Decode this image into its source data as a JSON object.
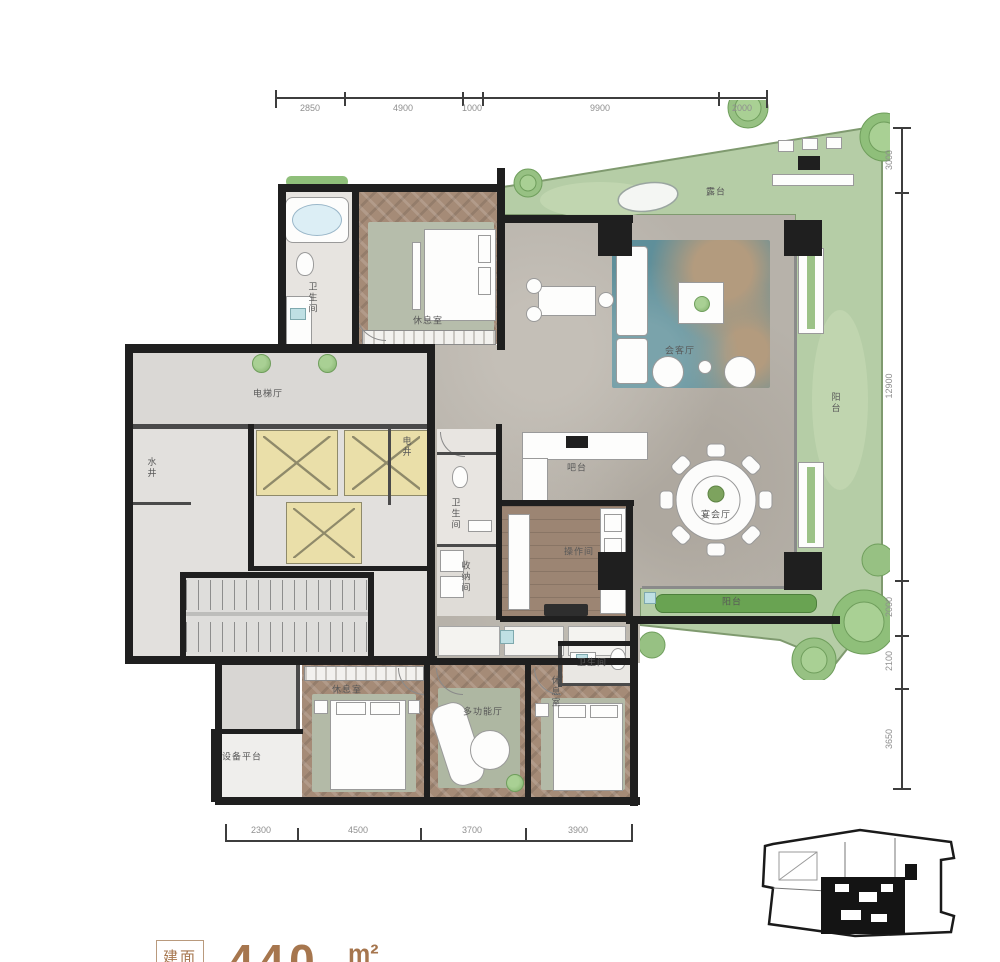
{
  "colors": {
    "wall": "#1f1f1f",
    "terrace_green": "#b5cda6",
    "marble_floor": "#b7b2aa",
    "wood_floor": "#a58b77",
    "rug_teal": "#5f8f9a",
    "elevator_yellow": "#eadfa9",
    "planter_green": "#69a352",
    "dim_text": "#8f8f8f",
    "footer_brown": "#a6764e"
  },
  "dims": {
    "top": [
      "2850",
      "4900",
      "1000",
      "9900",
      "2000"
    ],
    "right": [
      "3000",
      "12900",
      "2000",
      "2100",
      "3650"
    ],
    "bottom": [
      "2300",
      "4500",
      "3700",
      "3900"
    ]
  },
  "rooms": {
    "elevator_hall": "电梯厅",
    "water_shaft": "水井",
    "electric_shaft": "电井",
    "bath_top": "卫生间",
    "bedroom_top": "休息室",
    "terrace": "露台",
    "living": "会客厅",
    "balcony_right": "阳台",
    "bar": "吧台",
    "banquet": "宴会厅",
    "kitchen": "操作间",
    "bath_mid": "卫生间",
    "storage": "收纳间",
    "balcony_bottom": "阳台",
    "bedroom_left": "休息室",
    "multi_room": "多功能厅",
    "bedroom_right": "休息室",
    "bath_bottom": "卫生间",
    "equipment": "设备平台"
  },
  "footer": {
    "badge": "建面",
    "number": "440",
    "unit": "m²"
  },
  "icons": {
    "tree": "green circle canopy",
    "pond": "white oval water feature",
    "elevator_x": "crossed shaft symbol",
    "grill": "black outdoor cook box",
    "key_plan": "building footprint outline"
  }
}
